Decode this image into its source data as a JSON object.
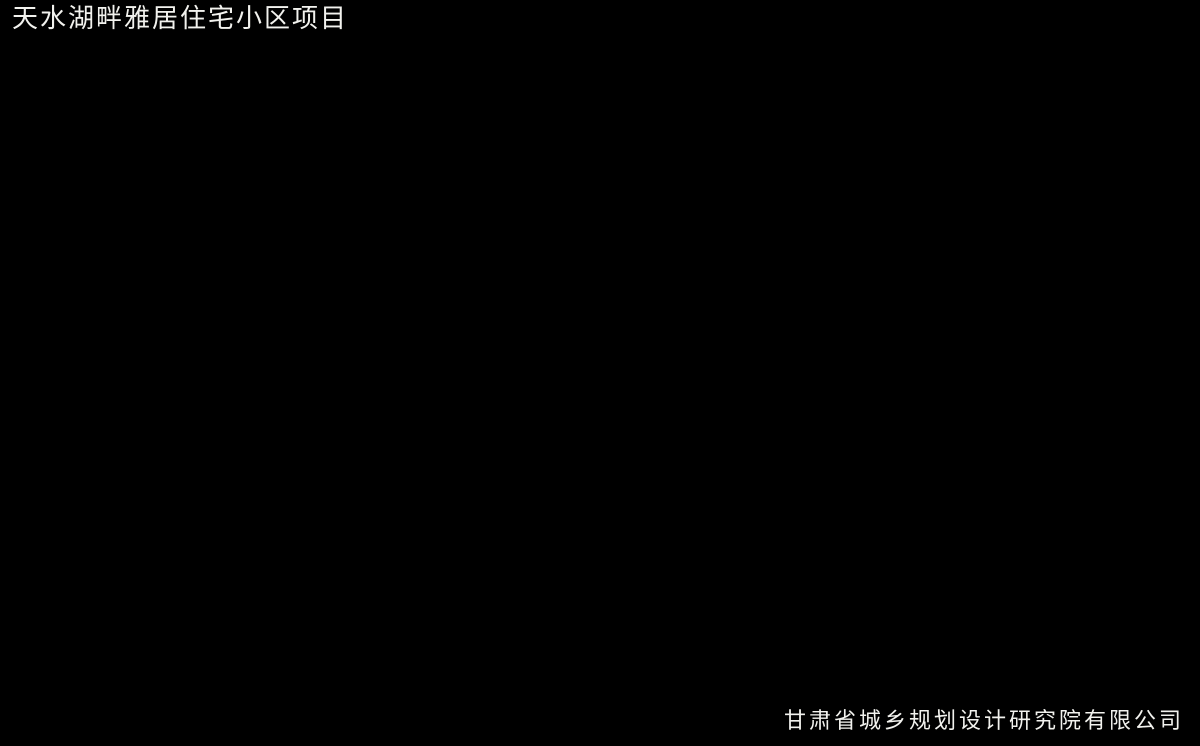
{
  "meta": {
    "width": 1200,
    "height": 746
  },
  "header": {
    "title": "天水湖畔雅居住宅小区项目"
  },
  "footer": {
    "company": "甘肃省城乡规划设计研究院有限公司"
  },
  "scene": {
    "kind": "aerial-architectural-rendering",
    "features": [
      "surrounding-forest",
      "morning-mist",
      "main-highway",
      "city-road",
      "junction-plaza",
      "entrance-axis",
      "circular-plaza",
      "residential-building-rows",
      "central-landscape-gardens",
      "swimming-pools",
      "basketball-courts",
      "tennis-courts",
      "boiler-chimney",
      "commercial-block"
    ]
  },
  "palette": {
    "bar_black": "#000000",
    "text_white": "#f2f2ee",
    "hill_light": "#93ad74",
    "forest_mid": "#66804a",
    "forest_deep": "#3f5a33",
    "forest_darkest": "#263722",
    "mist": "#e4eeea",
    "road_asphalt": "#54585c",
    "plaza_asphalt": "#565b60",
    "lane_yellow": "#d9b23e",
    "curb_light": "#c5c9c7",
    "site_base": "#c9c8b8",
    "building_white": "#f0eee3",
    "building_shade": "#b5b2a3",
    "building_shadow": "#2f3c28",
    "lawn": "#79a14c",
    "lawn_light": "#8bb05c",
    "tree_dark": "#2f4726",
    "tree_green": "#3f5c31",
    "tree_light": "#6f9149",
    "tree_yellow": "#d2c238",
    "tree_pink": "#b98ab0",
    "pool_blue": "#74aecb",
    "water_channel": "#6fa8c6",
    "pavilion_brown": "#8a4a28",
    "pergola_red": "#8a3f24",
    "accent_purple": "#6a4a7a",
    "accent_red": "#a4433a",
    "court_orange": "#bd6b49",
    "court_border": "#dccda4",
    "tennis_green": "#5f8f57",
    "tennis_red": "#a65040",
    "chimney_white": "#e9e9e3",
    "glass_blue": "#9fb0c4",
    "deck_beige": "#e3dfd0"
  }
}
